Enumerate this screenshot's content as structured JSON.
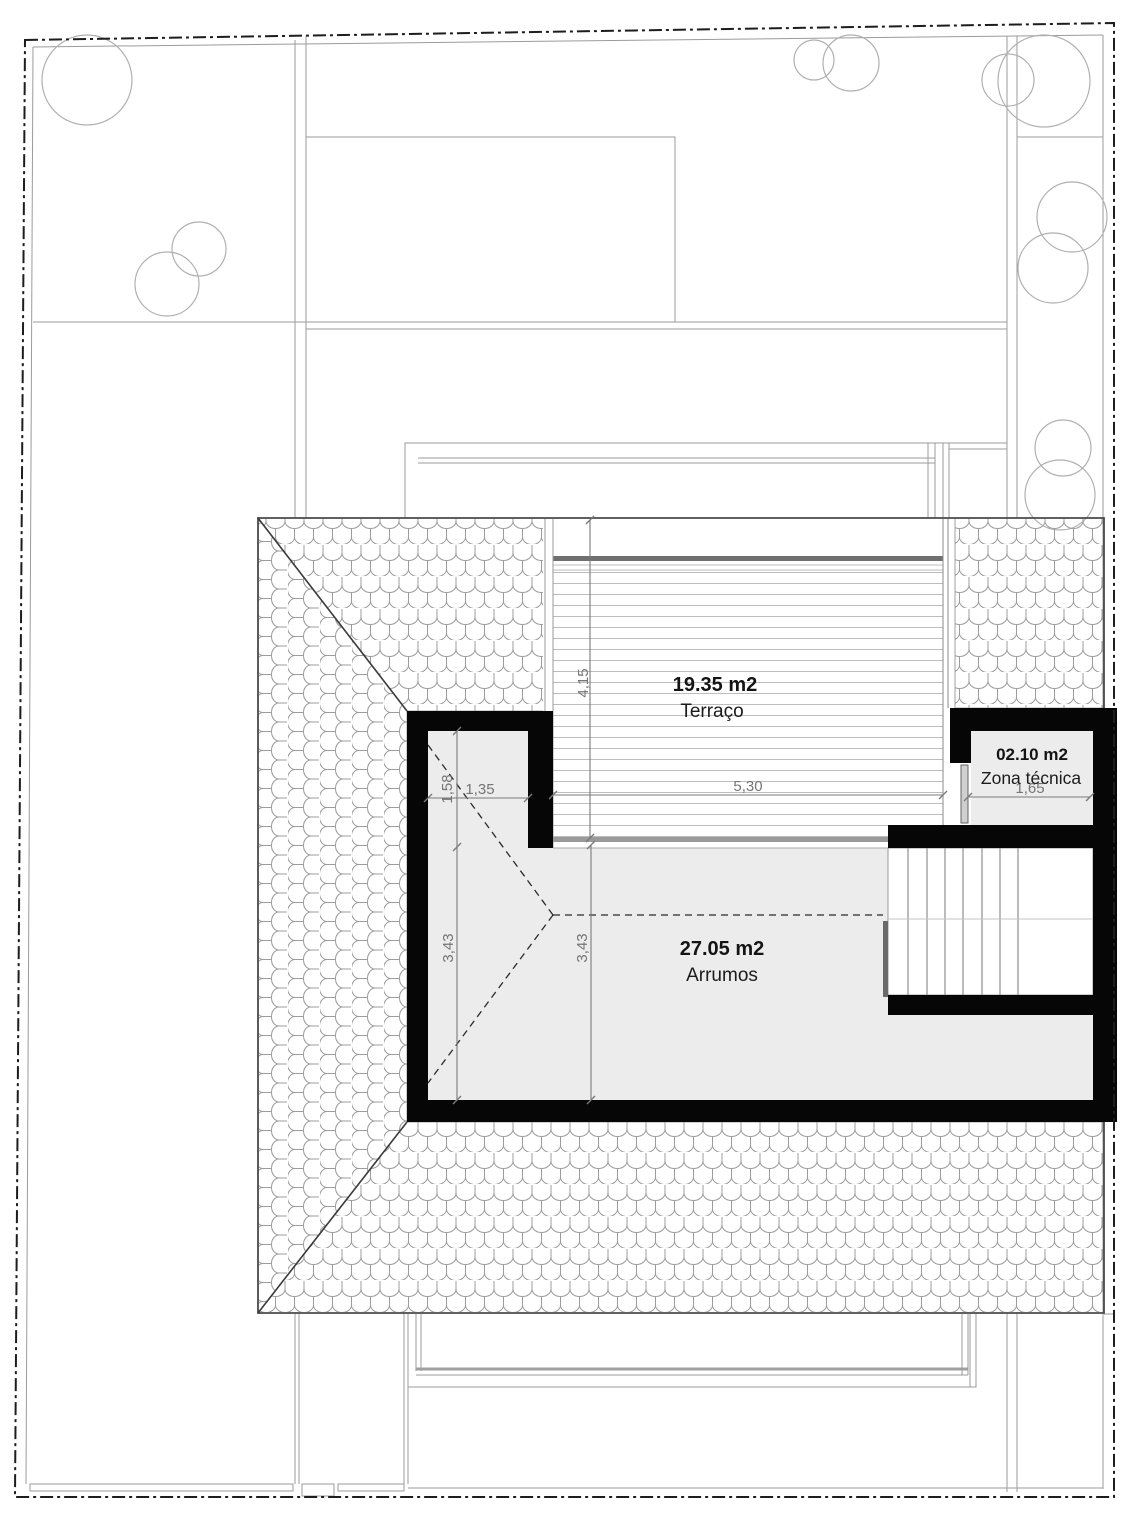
{
  "rooms": [
    {
      "area": "19.35 m2",
      "name": "Terraço"
    },
    {
      "area": "27.05 m2",
      "name": "Arrumos"
    },
    {
      "area": "02.10 m2",
      "name": "Zona técnica"
    }
  ],
  "dimensions": {
    "terrace_depth": "4,15",
    "terrace_width": "5,30",
    "alcove_width": "1,35",
    "alcove_depth": "1,58",
    "storage_depth_left": "3,43",
    "storage_depth_inner": "3,43",
    "technical_zone_width": "1,65"
  },
  "colors": {
    "wall": "#060606",
    "room_fill": "#ececec",
    "dimension": "#7a7a7a",
    "label": "#141414",
    "tile_line": "#9d9d9d"
  }
}
